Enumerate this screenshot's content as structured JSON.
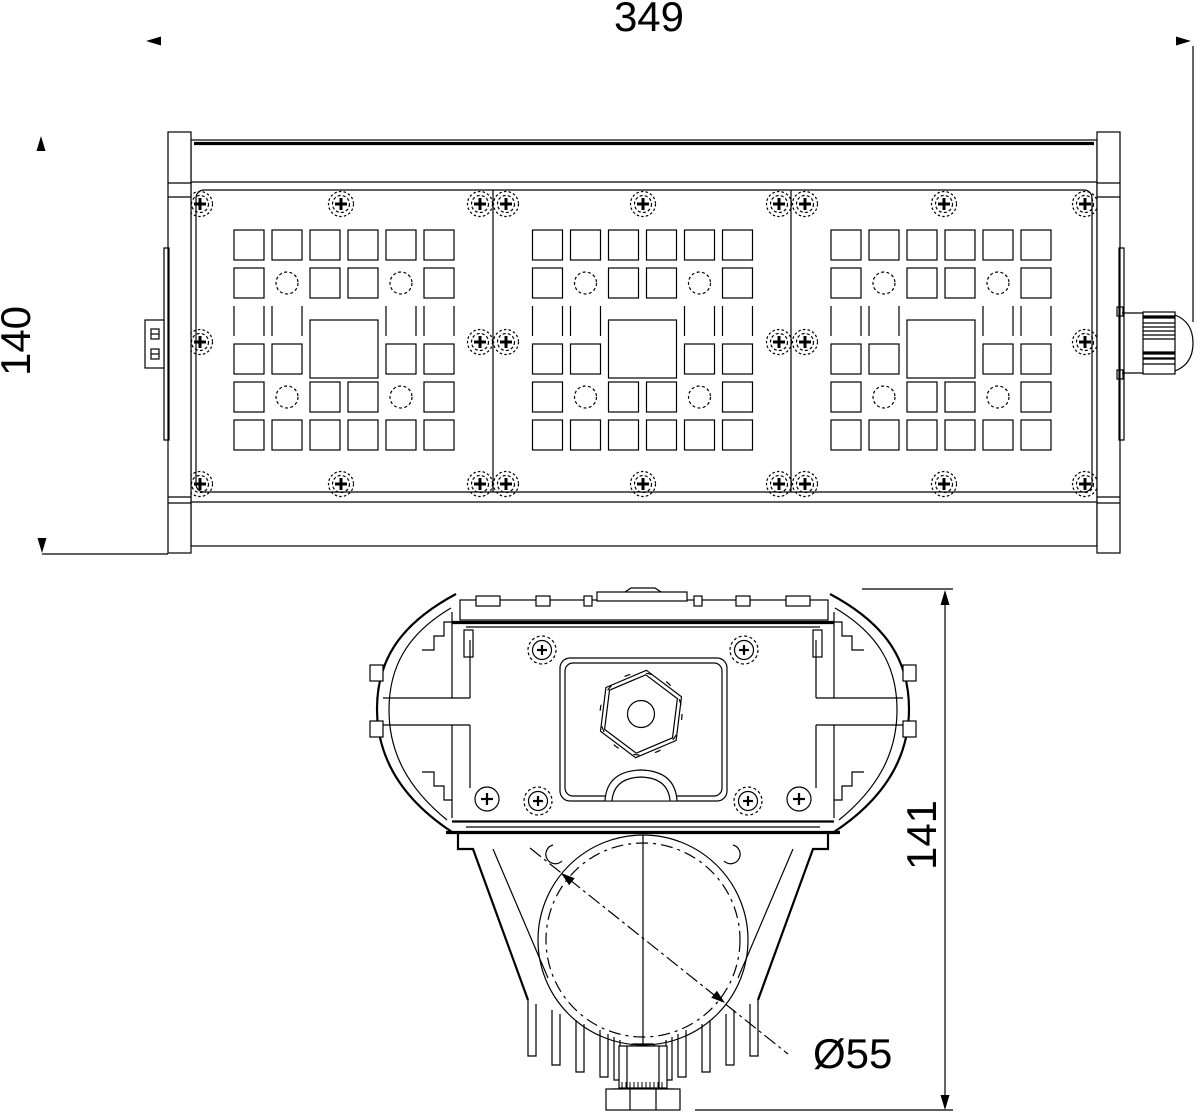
{
  "drawing": {
    "dimensions": {
      "width": "349",
      "height": "140",
      "section_height": "141",
      "pole_diameter": "Ø55"
    },
    "colors": {
      "line": "#000000",
      "background": "#ffffff"
    }
  }
}
